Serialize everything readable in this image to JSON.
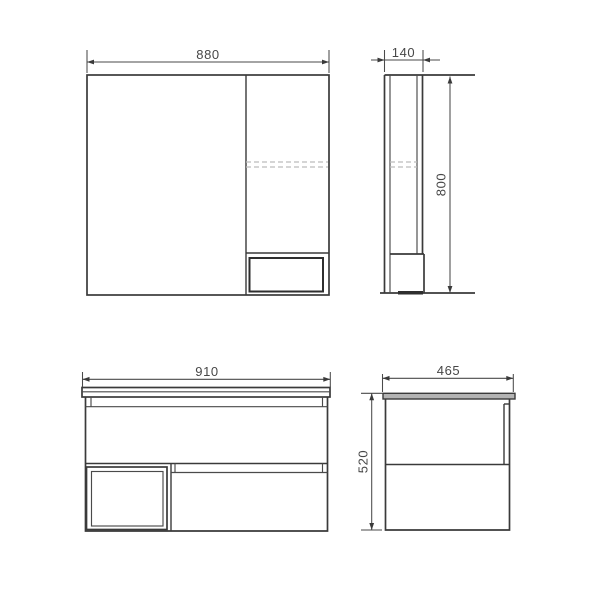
{
  "title": "bathroom-furniture-dimension-drawing",
  "colors": {
    "background": "#ffffff",
    "outline": "#3a3a3a",
    "dimension_line": "#4a4a4a",
    "hidden_line": "#bcbcbc",
    "label_text": "#474747",
    "countertop_fill": "#b3b3b3"
  },
  "views": {
    "mirror_front": {
      "name": "mirror-cabinet-front-view",
      "width_mm": "880"
    },
    "mirror_side": {
      "name": "mirror-cabinet-side-view",
      "depth_mm": "140",
      "height_mm": "800"
    },
    "vanity_front": {
      "name": "vanity-cabinet-front-view",
      "width_mm": "910"
    },
    "vanity_side": {
      "name": "vanity-cabinet-side-view",
      "depth_mm": "465",
      "height_mm": "520"
    }
  }
}
